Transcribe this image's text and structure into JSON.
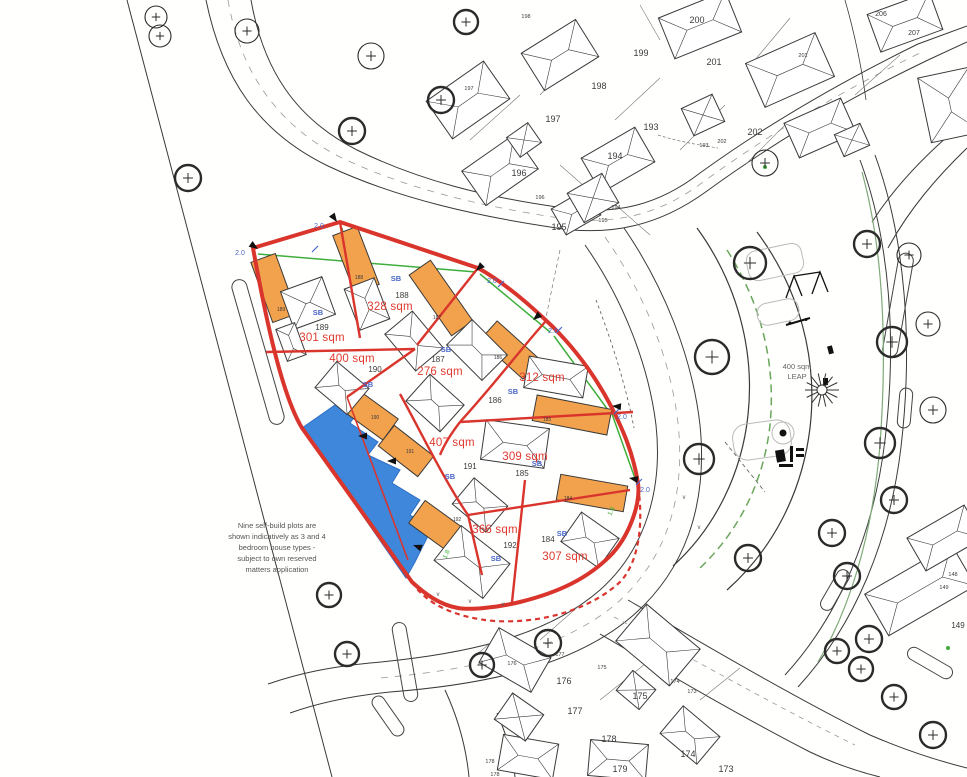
{
  "drawing": {
    "colors": {
      "site_boundary": "#d9352c",
      "area_label": "#e03a30",
      "building_fill": "#f2a24d",
      "pond_fill": "#3e87db",
      "pond_stroke": "#2f6fc5",
      "hedge_green": "#3fae3c",
      "dim_blue": "#4a66c8",
      "linework": "#3a3a3a"
    },
    "note": {
      "lines": [
        "Nine self-build plots are",
        "shown indicatively as 3 and 4",
        "bedroom house types -",
        "subject to own reserved",
        "matters application"
      ],
      "x": 277,
      "y": 528,
      "line_height": 11
    },
    "leap": {
      "area": "400 sqm",
      "name": "LEAP",
      "x": 797,
      "y": 369
    },
    "self_build_plots": [
      {
        "plot": "189",
        "area": "301 sqm",
        "marker": "SB",
        "area_x": 322,
        "area_y": 341,
        "num_x": 322,
        "num_y": 330,
        "sb_x": 318,
        "sb_y": 315
      },
      {
        "plot": "188",
        "area": "328 sqm",
        "marker": "SB",
        "area_x": 390,
        "area_y": 310,
        "num_x": 402,
        "num_y": 298,
        "sb_x": 396,
        "sb_y": 281
      },
      {
        "plot": "190",
        "area": "400 sqm",
        "marker": "SB",
        "area_x": 352,
        "area_y": 362,
        "num_x": 375,
        "num_y": 372,
        "sb_x": 368,
        "sb_y": 387
      },
      {
        "plot": "187",
        "area": "276 sqm",
        "marker": "SB",
        "area_x": 440,
        "area_y": 375,
        "num_x": 438,
        "num_y": 362,
        "sb_x": 446,
        "sb_y": 352
      },
      {
        "plot": "186",
        "area": "312 sqm",
        "marker": "SB",
        "area_x": 542,
        "area_y": 381,
        "num_x": 495,
        "num_y": 403,
        "sb_x": 513,
        "sb_y": 394
      },
      {
        "plot": "191",
        "area": "407 sqm",
        "marker": "SB",
        "area_x": 452,
        "area_y": 446,
        "num_x": 470,
        "num_y": 469,
        "sb_x": 450,
        "sb_y": 479
      },
      {
        "plot": "185",
        "area": "309 sqm",
        "marker": "SB",
        "area_x": 525,
        "area_y": 460,
        "num_x": 522,
        "num_y": 476,
        "sb_x": 537,
        "sb_y": 466
      },
      {
        "plot": "192",
        "area": "366 sqm",
        "marker": "SB",
        "area_x": 495,
        "area_y": 533,
        "num_x": 510,
        "num_y": 548,
        "sb_x": 496,
        "sb_y": 561
      },
      {
        "plot": "184",
        "area": "307 sqm",
        "marker": "SB",
        "area_x": 565,
        "area_y": 560,
        "num_x": 548,
        "num_y": 542,
        "sb_x": 562,
        "sb_y": 536
      }
    ],
    "garage_numbers": [
      {
        "text": "189",
        "x": 281,
        "y": 311
      },
      {
        "text": "188",
        "x": 359,
        "y": 279
      },
      {
        "text": "187",
        "x": 437,
        "y": 319
      },
      {
        "text": "186",
        "x": 498,
        "y": 359
      },
      {
        "text": "185",
        "x": 547,
        "y": 421
      },
      {
        "text": "184",
        "x": 568,
        "y": 500
      },
      {
        "text": "190",
        "x": 375,
        "y": 419
      },
      {
        "text": "191",
        "x": 410,
        "y": 453
      },
      {
        "text": "192",
        "x": 457,
        "y": 521
      }
    ],
    "surrounding_plot_numbers": [
      {
        "text": "200",
        "x": 697,
        "y": 23,
        "size": 9
      },
      {
        "text": "199",
        "x": 641,
        "y": 56,
        "size": 9
      },
      {
        "text": "198",
        "x": 599,
        "y": 89,
        "size": 9
      },
      {
        "text": "201",
        "x": 714,
        "y": 65,
        "size": 9
      },
      {
        "text": "197",
        "x": 553,
        "y": 122,
        "size": 9
      },
      {
        "text": "193",
        "x": 651,
        "y": 130,
        "size": 9
      },
      {
        "text": "202",
        "x": 755,
        "y": 135,
        "size": 9
      },
      {
        "text": "194",
        "x": 615,
        "y": 159,
        "size": 9
      },
      {
        "text": "196",
        "x": 519,
        "y": 176,
        "size": 9
      },
      {
        "text": "195",
        "x": 559,
        "y": 230,
        "size": 9
      },
      {
        "text": "206",
        "x": 881,
        "y": 16,
        "size": 7
      },
      {
        "text": "207",
        "x": 914,
        "y": 35,
        "size": 7
      },
      {
        "text": "176",
        "x": 564,
        "y": 684,
        "size": 9
      },
      {
        "text": "177",
        "x": 575,
        "y": 714,
        "size": 9
      },
      {
        "text": "178",
        "x": 609,
        "y": 742,
        "size": 9
      },
      {
        "text": "175",
        "x": 640,
        "y": 699,
        "size": 9
      },
      {
        "text": "174",
        "x": 688,
        "y": 757,
        "size": 9
      },
      {
        "text": "179",
        "x": 620,
        "y": 772,
        "size": 9
      },
      {
        "text": "173",
        "x": 726,
        "y": 772,
        "size": 9
      },
      {
        "text": "149",
        "x": 958,
        "y": 628,
        "size": 8
      },
      {
        "text": "198",
        "x": 526,
        "y": 18,
        "size": 5.5
      },
      {
        "text": "197",
        "x": 469,
        "y": 90,
        "size": 5.5
      },
      {
        "text": "201",
        "x": 803,
        "y": 57,
        "size": 5.5
      },
      {
        "text": "193",
        "x": 704,
        "y": 147,
        "size": 5.5
      },
      {
        "text": "202",
        "x": 722,
        "y": 143,
        "size": 5.5
      },
      {
        "text": "196",
        "x": 540,
        "y": 199,
        "size": 5.5
      },
      {
        "text": "194",
        "x": 616,
        "y": 209,
        "size": 5.5
      },
      {
        "text": "195",
        "x": 603,
        "y": 222,
        "size": 5.5
      },
      {
        "text": "174",
        "x": 675,
        "y": 683,
        "size": 5.5
      },
      {
        "text": "173",
        "x": 692,
        "y": 693,
        "size": 5.5
      },
      {
        "text": "175",
        "x": 602,
        "y": 669,
        "size": 5.5
      },
      {
        "text": "176",
        "x": 512,
        "y": 665,
        "size": 5.5
      },
      {
        "text": "177",
        "x": 560,
        "y": 656,
        "size": 5.5
      },
      {
        "text": "178",
        "x": 490,
        "y": 763,
        "size": 5.5
      },
      {
        "text": "178",
        "x": 495,
        "y": 776,
        "size": 5.5
      },
      {
        "text": "148",
        "x": 953,
        "y": 576,
        "size": 5.5
      },
      {
        "text": "149",
        "x": 944,
        "y": 589,
        "size": 5.5
      }
    ],
    "dimension_labels": [
      {
        "text": "2.0",
        "x": 240,
        "y": 255,
        "color": "blue",
        "rotate": 0
      },
      {
        "text": "2.0",
        "x": 319,
        "y": 228,
        "color": "blue",
        "rotate": 0
      },
      {
        "text": "2.0",
        "x": 492,
        "y": 283,
        "color": "blue",
        "rotate": 0
      },
      {
        "text": "2.0",
        "x": 553,
        "y": 333,
        "color": "blue",
        "rotate": 0
      },
      {
        "text": "2.0",
        "x": 622,
        "y": 419,
        "color": "blue",
        "rotate": 0
      },
      {
        "text": "2.0",
        "x": 645,
        "y": 492,
        "color": "blue",
        "rotate": 0
      },
      {
        "text": "1.8",
        "x": 613,
        "y": 512,
        "color": "green",
        "rotate": -65
      },
      {
        "text": "1.8",
        "x": 448,
        "y": 555,
        "color": "green",
        "rotate": -65
      }
    ],
    "v_marks": [
      {
        "x": 438,
        "y": 596
      },
      {
        "x": 470,
        "y": 603
      },
      {
        "x": 503,
        "y": 606
      },
      {
        "x": 684,
        "y": 499
      },
      {
        "x": 699,
        "y": 529
      }
    ],
    "trees": [
      {
        "x": 156,
        "y": 17,
        "r": 11,
        "bold": false
      },
      {
        "x": 160,
        "y": 36,
        "r": 11,
        "bold": false
      },
      {
        "x": 247,
        "y": 31,
        "r": 12,
        "bold": false
      },
      {
        "x": 188,
        "y": 178,
        "r": 13,
        "bold": true
      },
      {
        "x": 352,
        "y": 131,
        "r": 13,
        "bold": true
      },
      {
        "x": 371,
        "y": 56,
        "r": 13,
        "bold": false
      },
      {
        "x": 441,
        "y": 100,
        "r": 13,
        "bold": true
      },
      {
        "x": 466,
        "y": 22,
        "r": 12,
        "bold": true
      },
      {
        "x": 765,
        "y": 163,
        "r": 13,
        "bold": false
      },
      {
        "x": 750,
        "y": 263,
        "r": 16,
        "bold": true
      },
      {
        "x": 867,
        "y": 244,
        "r": 13,
        "bold": true
      },
      {
        "x": 909,
        "y": 255,
        "r": 12,
        "bold": false
      },
      {
        "x": 712,
        "y": 357,
        "r": 17,
        "bold": true
      },
      {
        "x": 892,
        "y": 342,
        "r": 15,
        "bold": true
      },
      {
        "x": 928,
        "y": 324,
        "r": 12,
        "bold": false
      },
      {
        "x": 933,
        "y": 410,
        "r": 13,
        "bold": false
      },
      {
        "x": 880,
        "y": 443,
        "r": 15,
        "bold": true
      },
      {
        "x": 699,
        "y": 459,
        "r": 15,
        "bold": true
      },
      {
        "x": 832,
        "y": 533,
        "r": 13,
        "bold": true
      },
      {
        "x": 894,
        "y": 500,
        "r": 13,
        "bold": true
      },
      {
        "x": 847,
        "y": 576,
        "r": 13,
        "bold": true
      },
      {
        "x": 869,
        "y": 639,
        "r": 13,
        "bold": true
      },
      {
        "x": 837,
        "y": 651,
        "r": 12,
        "bold": true
      },
      {
        "x": 861,
        "y": 669,
        "r": 12,
        "bold": true
      },
      {
        "x": 894,
        "y": 697,
        "r": 12,
        "bold": true
      },
      {
        "x": 933,
        "y": 735,
        "r": 13,
        "bold": true
      },
      {
        "x": 329,
        "y": 595,
        "r": 12,
        "bold": true
      },
      {
        "x": 347,
        "y": 654,
        "r": 12,
        "bold": true
      },
      {
        "x": 482,
        "y": 665,
        "r": 12,
        "bold": true
      },
      {
        "x": 548,
        "y": 643,
        "r": 13,
        "bold": true
      },
      {
        "x": 748,
        "y": 558,
        "r": 13,
        "bold": true
      }
    ],
    "boundary_arrows": [
      {
        "x": 258,
        "y": 249,
        "angle": 35
      },
      {
        "x": 337,
        "y": 222,
        "angle": 55
      },
      {
        "x": 476,
        "y": 271,
        "angle": 135
      },
      {
        "x": 533,
        "y": 320,
        "angle": 140
      },
      {
        "x": 612,
        "y": 406,
        "angle": 185
      },
      {
        "x": 629,
        "y": 478,
        "angle": 190
      },
      {
        "x": 358,
        "y": 436,
        "angle": 180
      },
      {
        "x": 387,
        "y": 461,
        "angle": 180
      },
      {
        "x": 413,
        "y": 545,
        "angle": 200
      }
    ]
  }
}
